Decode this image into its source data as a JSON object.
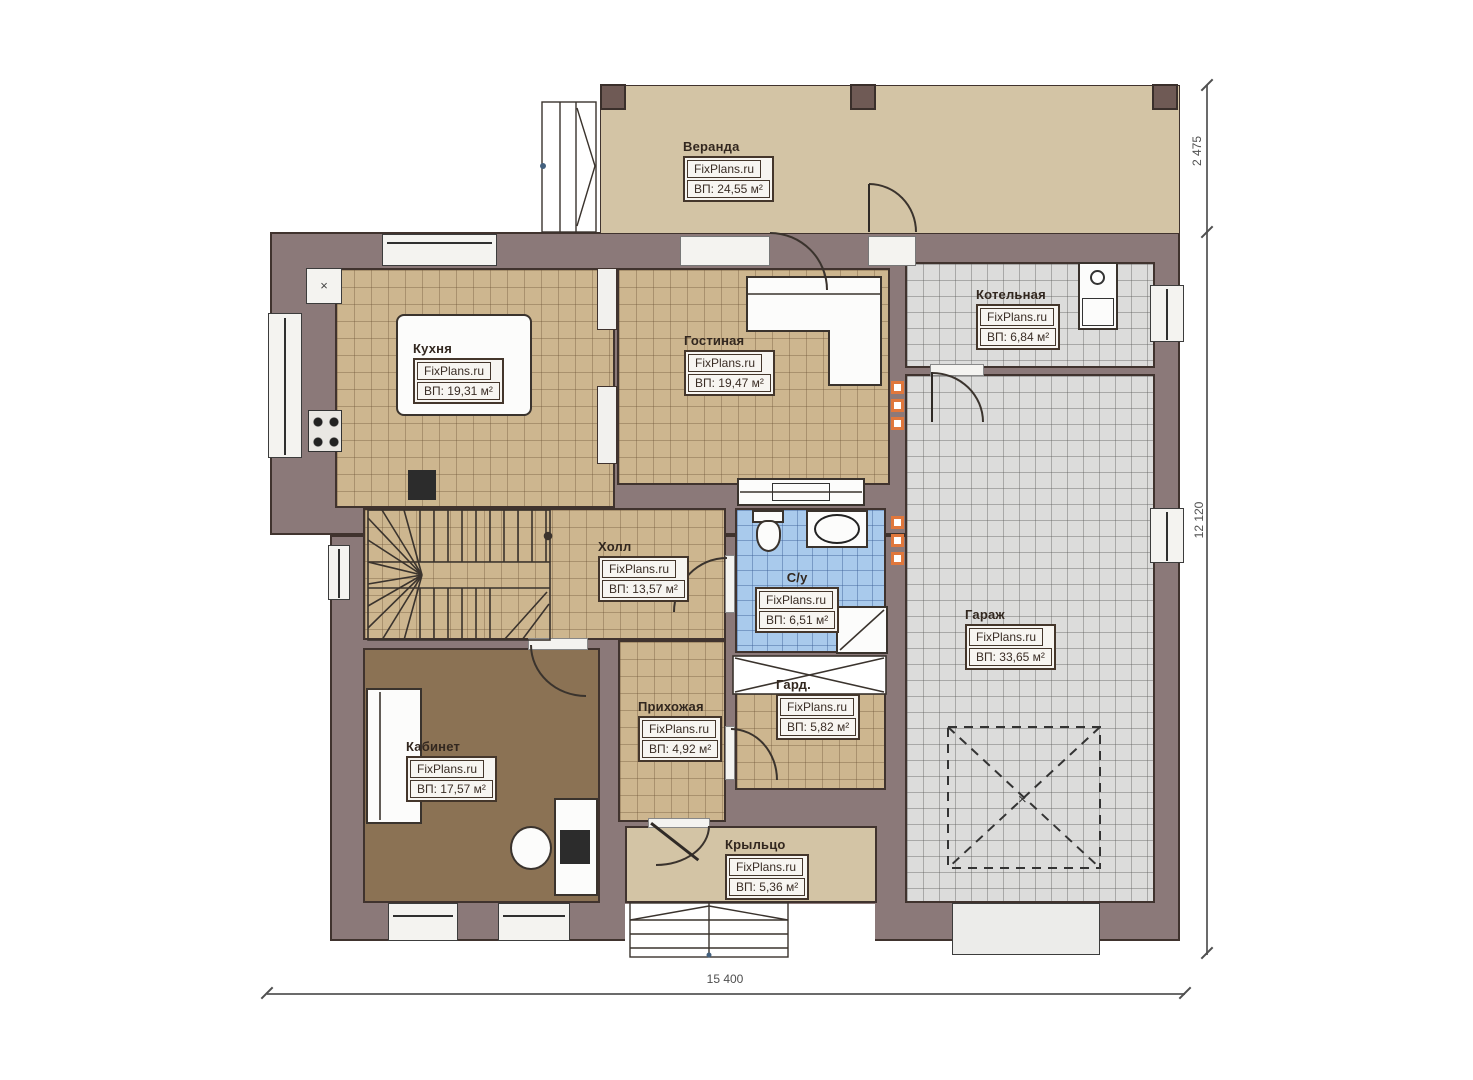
{
  "rooms": [
    {
      "id": "veranda",
      "name": "Веранда",
      "site": "FixPlans.ru",
      "area": "ВП: 24,55 м²"
    },
    {
      "id": "kitchen",
      "name": "Кухня",
      "site": "FixPlans.ru",
      "area": "ВП: 19,31 м²"
    },
    {
      "id": "living",
      "name": "Гостиная",
      "site": "FixPlans.ru",
      "area": "ВП: 19,47 м²"
    },
    {
      "id": "boiler",
      "name": "Котельная",
      "site": "FixPlans.ru",
      "area": "ВП: 6,84 м²"
    },
    {
      "id": "hall",
      "name": "Холл",
      "site": "FixPlans.ru",
      "area": "ВП: 13,57 м²"
    },
    {
      "id": "bath",
      "name": "С/у",
      "site": "FixPlans.ru",
      "area": "ВП: 6,51 м²"
    },
    {
      "id": "garage",
      "name": "Гараж",
      "site": "FixPlans.ru",
      "area": "ВП: 33,65 м²"
    },
    {
      "id": "office",
      "name": "Кабинет",
      "site": "FixPlans.ru",
      "area": "ВП: 17,57 м²"
    },
    {
      "id": "entry",
      "name": "Прихожая",
      "site": "FixPlans.ru",
      "area": "ВП: 4,92 м²"
    },
    {
      "id": "wardrobe",
      "name": "Гард.",
      "site": "FixPlans.ru",
      "area": "ВП: 5,82 м²"
    },
    {
      "id": "porch",
      "name": "Крыльцо",
      "site": "FixPlans.ru",
      "area": "ВП: 5,36 м²"
    }
  ],
  "dimensions": {
    "veranda_depth": "2 475",
    "house_depth": "12 120",
    "house_width": "15 400"
  },
  "symbols": {
    "vent_cross": "×",
    "car_cross": "×"
  },
  "colors": {
    "wall": "#8b7979",
    "tile": "#cdb68f",
    "garage_floor": "#dcdcdb",
    "bath_tile": "#a9caec",
    "office_floor": "#8b7254",
    "veranda_floor": "#d3c4a5",
    "accent_orange": "#e0773c"
  }
}
